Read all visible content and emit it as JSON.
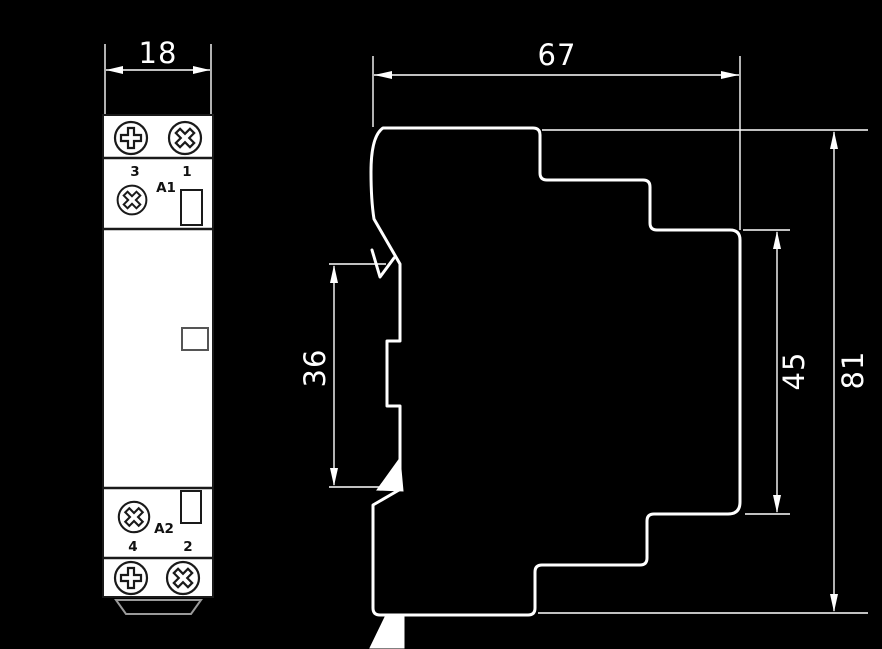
{
  "drawing": {
    "type": "dimension-drawing",
    "views": [
      "front",
      "side-profile"
    ]
  },
  "colors": {
    "background": "#000000",
    "dimension_art": "#ffffff",
    "module_face": "#ffffff",
    "module_details": "#1a1a1a",
    "foot_outline": "#9a9a9a"
  },
  "front_view": {
    "width_mm": "18",
    "terminal_top_left": "3",
    "terminal_top_right": "1",
    "coil_terminal_top": "A1",
    "coil_terminal_bottom": "A2",
    "terminal_bottom_left": "4",
    "terminal_bottom_right": "2"
  },
  "side_view": {
    "depth_mm": "67",
    "din_rail_section_mm": "36",
    "rear_height_mm": "45",
    "overall_height_mm": "81"
  }
}
